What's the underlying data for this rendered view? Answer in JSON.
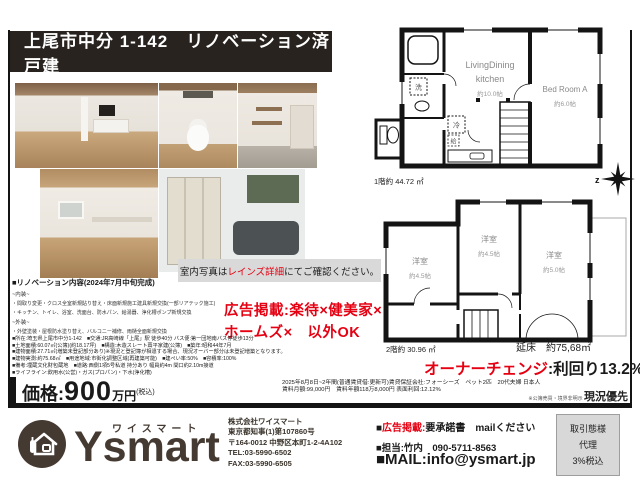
{
  "title": "上尾市中分 1-142　リノベーション済戸建",
  "photo_note": {
    "prefix": "室内写真は",
    "highlight": "レインズ詳細",
    "suffix": "にてご確認ください。"
  },
  "renovation": {
    "heading": "■リノベーション内容(2024年7月中旬完成)",
    "interior_label": "~内装~",
    "items_interior": [
      "・間取り変更・クロス全室新規貼り替え・床面新規施工建具新規交換(一部リアテック施工)",
      "・キッチン、トイレ、浴室、洗面台、防水パン、給湯器、浄化槽ポンプ新規交換"
    ],
    "exterior_label": "~外装~",
    "items_exterior": [
      "・外壁塗装・屋根防水塗り替え、バルコニー補修、雨樋全面新規交換"
    ]
  },
  "ad_notice": {
    "line1": "広告掲載:楽待×健美家×",
    "line2": "ホームズ×　以外OK"
  },
  "details": [
    "■所在:埼玉県上尾市中分1-142　■交通:JR高崎線「上尾」駅 徒歩40分 バス便:第一団地南バス停徒歩13分",
    "■土地面積:60.07㎡(公簿)(約18.17坪)　■構造:木造スレート葺平家建(公簿)　■築年:昭和44年7月",
    "■建物面積:27.71㎡(増築未登記部分あり)※現況と登記簿が相違する場合、現況オーバー部分は未登記増築となります。",
    "■建物実測:約75.68㎡　■用途地域:市街化調整区域(再建築可能)　■建ぺい率:50%　■容積率:100%",
    "■備考:埋蔵文化財包蔵地　■道路:西側1項5号私道 持分あり 幅員約4m 間口約2.10m接道",
    "■ライフライン:飲用水(公営)・ガス(プロパン)・下水(浄化槽)"
  ],
  "price": {
    "label": "価格:",
    "amount": "900",
    "unit": "万円",
    "tax": "(税込)"
  },
  "lease": {
    "line1": "2025年8月8日~2年間(普通賃貸借:更新可)賃貸保証会社:フォーシーズ　ペット2匹　20代夫婦 日本人",
    "line2": "賃料月額:99,000円　賃料年額118万8,000円 表面利回:12.12%"
  },
  "owner_change": {
    "highlight": "オーナーチェンジ",
    "rest": ":利回り13.2%"
  },
  "disclaimer": {
    "small": "※公簿売買・境界非明示 ",
    "big": "現況優先"
  },
  "floorplan1": {
    "room1_line1": "LivingDining",
    "room1_line2": "kitchen",
    "room1_size": "約10.0帖",
    "room2_name": "Bed Room A",
    "room2_size": "約6.0帖",
    "tag_wash": "洗",
    "tag_fridge": "冷",
    "tag_kyu": "給",
    "caption": "1階約 44.72 ㎡",
    "compass": "z"
  },
  "floorplan2": {
    "room1_name": "洋室",
    "room1_size": "約4.5帖",
    "room2_name": "洋室",
    "room2_size": "約4.5帖",
    "room3_name": "洋室",
    "room3_size": "約5.0帖",
    "caption": "2階約 30.96 ㎡",
    "total": "延床　約75,68㎡"
  },
  "footer": {
    "brand_kana": "ワイスマート",
    "brand": "Ysmart",
    "company_lines": [
      "株式会社ワイスマート",
      "東京都知事(1)第107860号",
      "〒164-0012 中野区本町1-2-4A102",
      "TEL:03-5990-6502",
      "FAX:03-5990-6505"
    ],
    "ad_bullet": "■",
    "ad_label": "広告掲載:",
    "ad_rest": "要承諾書　mailください",
    "contact": "■担当:竹内　090-5711-8563",
    "mail": "■MAIL:info@ysmart.jp",
    "deal": [
      "取引態様",
      "代理",
      "3%税込"
    ]
  },
  "colors": {
    "accent_red": "#e50012",
    "brand_dark": "#453a32",
    "title_bg": "#28231f"
  }
}
